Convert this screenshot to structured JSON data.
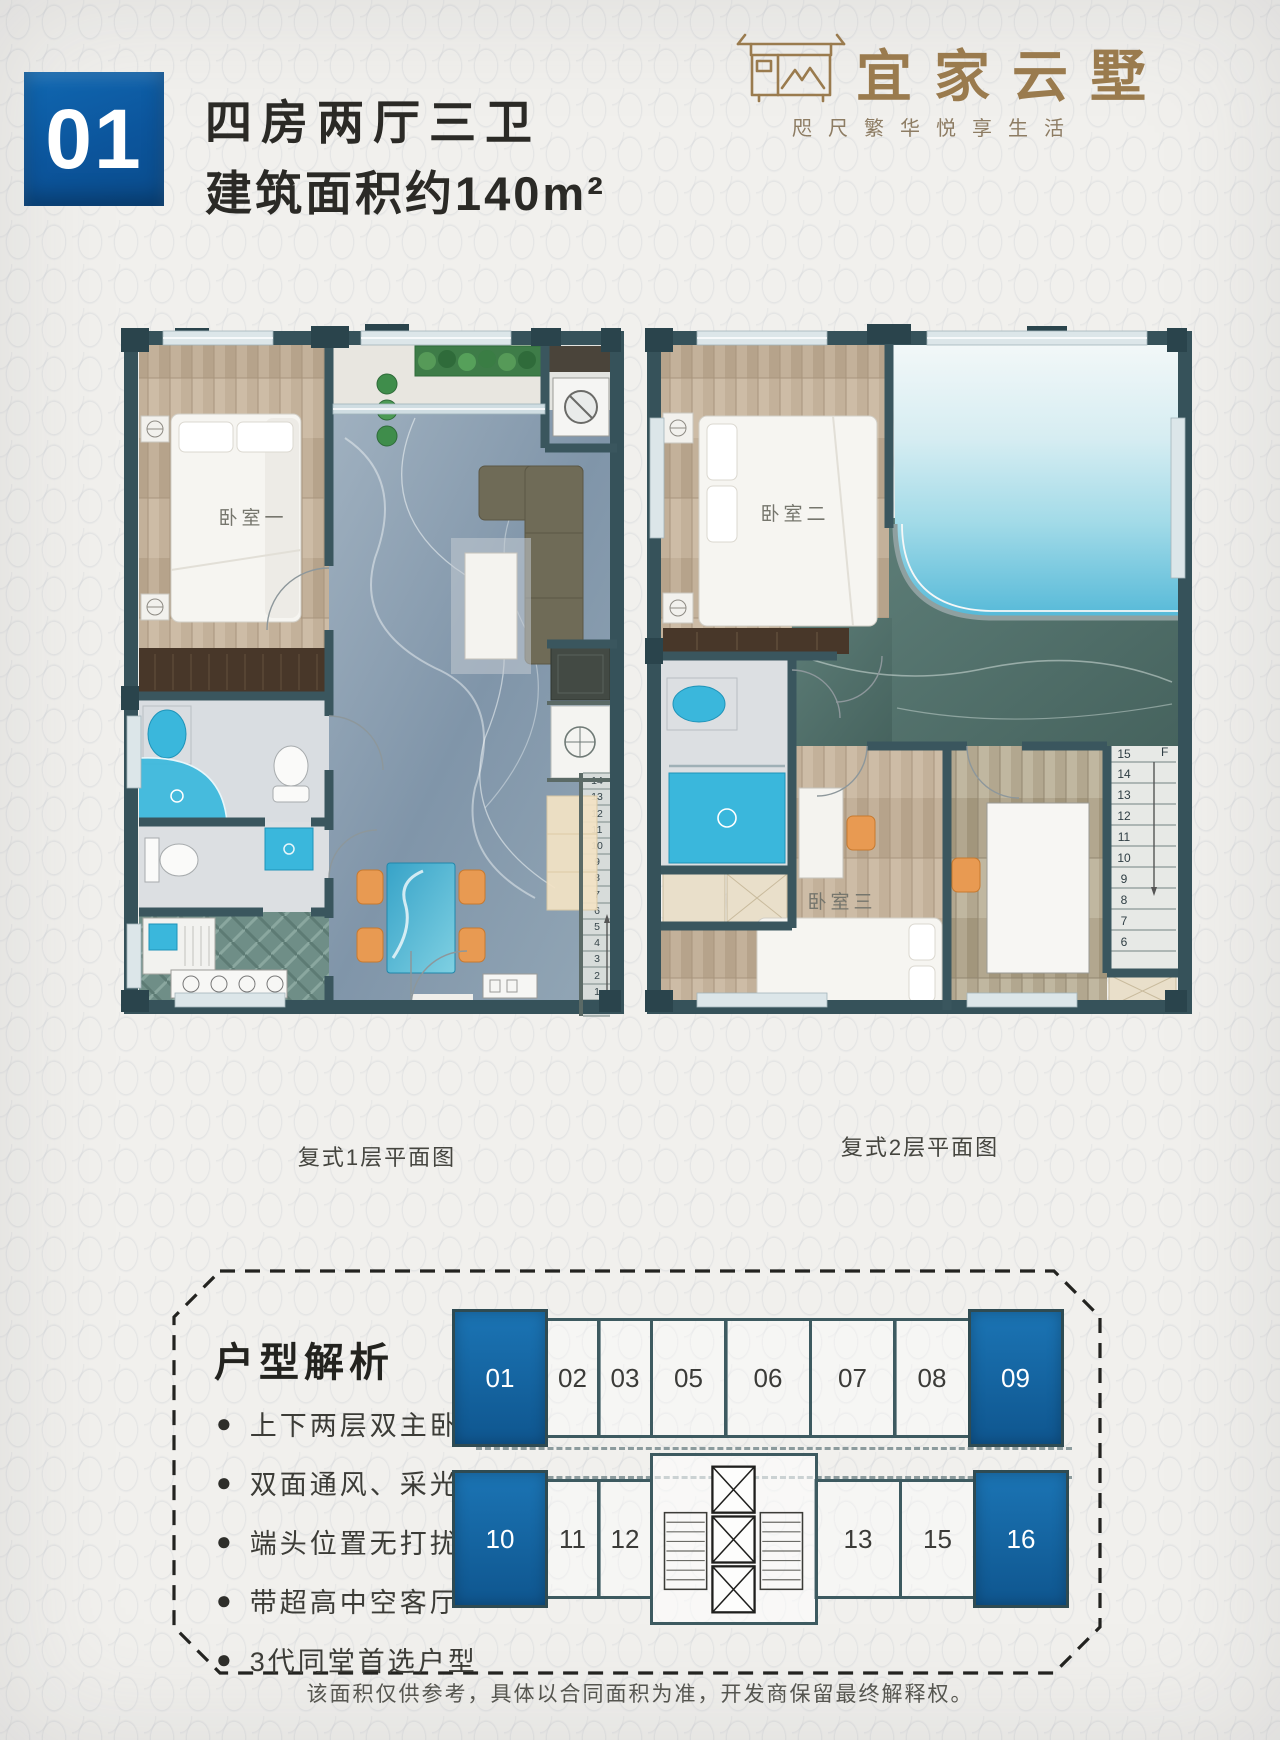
{
  "header": {
    "unit_no": "01",
    "title_line1": "四房两厅三卫",
    "title_line2": "建筑面积约140m²"
  },
  "brand": {
    "name": "宜家云墅",
    "tagline": "咫尺繁华悦享生活"
  },
  "plan1": {
    "caption": "复式1层平面图",
    "bedroom1_label": "卧室一",
    "stair_numbers": [
      "1",
      "2",
      "3",
      "4",
      "5",
      "6",
      "7",
      "8",
      "9",
      "10",
      "11",
      "12",
      "13",
      "14"
    ]
  },
  "plan2": {
    "caption": "复式2层平面图",
    "bedroom2_label": "卧室二",
    "bedroom3_label": "卧室三",
    "stair_direction_label": "F",
    "stair_numbers": [
      "6",
      "7",
      "8",
      "9",
      "10",
      "11",
      "12",
      "13",
      "14",
      "15"
    ]
  },
  "analysis": {
    "heading": "户型解析",
    "features": [
      "上下两层双主卧",
      "双面通风、采光",
      "端头位置无打扰",
      "带超高中空客厅",
      "3代同堂首选户型"
    ]
  },
  "floor_diagram": {
    "top_row": [
      "01",
      "02",
      "03",
      "05",
      "06",
      "07",
      "08",
      "09"
    ],
    "bottom_row": [
      "10",
      "11",
      "12",
      "13",
      "15",
      "16"
    ],
    "highlighted_units": [
      "01",
      "09",
      "10",
      "16"
    ]
  },
  "footer": "该面积仅供参考，具体以合同面积为准，开发商保留最终解释权。",
  "colors": {
    "accent_blue": "#0d5ba6",
    "unit_highlight_blue": "#15629f",
    "logo_gold": "#9a7b4e",
    "wall_teal": "#36525a",
    "fixture_blue": "#3ab7dc",
    "pool_blue": "#55b9d8"
  }
}
